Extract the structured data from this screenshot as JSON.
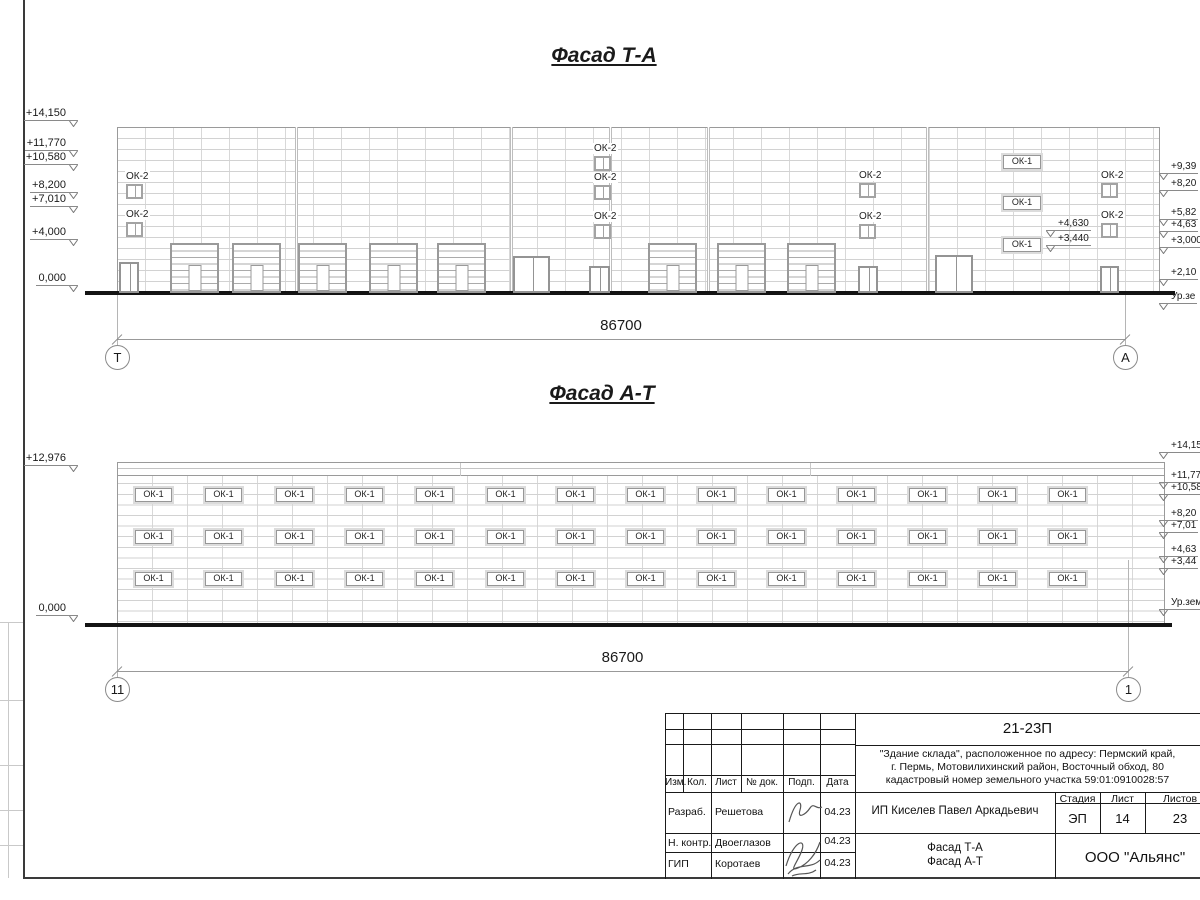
{
  "colors": {
    "line": "#1a1a1a",
    "grid": "#d2d2d2",
    "frame": "#979797",
    "ground": "#141414"
  },
  "facade1": {
    "title": "Фасад Т-А",
    "dimension": "86700",
    "axis_left": "Т",
    "axis_right": "А",
    "small_window_label": "ОК-2",
    "wide_window_label": "ОК-1",
    "marks_left": [
      {
        "t": "+14,150",
        "y": 107
      },
      {
        "t": "+11,770",
        "y": 137
      },
      {
        "t": "+10,580",
        "y": 151
      },
      {
        "t": "+8,200",
        "y": 179
      },
      {
        "t": "+7,010",
        "y": 193
      },
      {
        "t": "+4,000",
        "y": 226
      },
      {
        "t": "0,000",
        "y": 272
      }
    ],
    "marks_right": [
      {
        "t": "+9,39",
        "y": 161
      },
      {
        "t": "+8,20",
        "y": 178
      },
      {
        "t": "+5,82",
        "y": 207
      },
      {
        "t": "+4,63",
        "y": 219
      },
      {
        "t": "+3,000",
        "y": 235
      },
      {
        "t": "+2,10",
        "y": 267
      },
      {
        "t": "Ур.зе",
        "y": 291
      }
    ],
    "inner_marks": [
      {
        "t": "+4,630",
        "x": 1046,
        "y": 218
      },
      {
        "t": "+3,440",
        "x": 1046,
        "y": 233
      }
    ],
    "small_windows": [
      {
        "x": 126,
        "y": 184
      },
      {
        "x": 126,
        "y": 222
      },
      {
        "x": 594,
        "y": 156
      },
      {
        "x": 594,
        "y": 185
      },
      {
        "x": 594,
        "y": 224
      },
      {
        "x": 859,
        "y": 183
      },
      {
        "x": 859,
        "y": 224
      },
      {
        "x": 1101,
        "y": 183
      },
      {
        "x": 1101,
        "y": 223
      }
    ],
    "wide_windows": [
      {
        "x": 1003,
        "y": 155
      },
      {
        "x": 1003,
        "y": 196
      },
      {
        "x": 1003,
        "y": 238
      }
    ],
    "roller_doors_x": [
      170,
      232,
      298,
      369,
      437,
      648,
      717,
      787
    ],
    "single_doors": [
      {
        "x": 119,
        "y": 262,
        "w": 20,
        "h": 31
      },
      {
        "x": 589,
        "y": 266,
        "w": 21,
        "h": 27
      },
      {
        "x": 858,
        "y": 266,
        "w": 20,
        "h": 27
      },
      {
        "x": 1100,
        "y": 266,
        "w": 19,
        "h": 27
      }
    ],
    "double_doors": [
      {
        "x": 513,
        "y": 256,
        "w": 37,
        "h": 37
      },
      {
        "x": 935,
        "y": 255,
        "w": 38,
        "h": 38
      }
    ]
  },
  "facade2": {
    "title": "Фасад А-Т",
    "dimension": "86700",
    "axis_left": "11",
    "axis_right": "1",
    "window_label": "ОК-1",
    "window_cols_x": [
      135,
      205,
      276,
      346,
      416,
      487,
      557,
      627,
      698,
      768,
      838,
      909,
      979,
      1049
    ],
    "window_rows_y": [
      488,
      530,
      572
    ],
    "marks_left": [
      {
        "t": "+12,976",
        "y": 452
      },
      {
        "t": "0,000",
        "y": 602
      }
    ],
    "marks_right": [
      {
        "t": "+14,15",
        "y": 440
      },
      {
        "t": "+11,77",
        "y": 470
      },
      {
        "t": "+10,58",
        "y": 482
      },
      {
        "t": "+8,20",
        "y": 508
      },
      {
        "t": "+7,01",
        "y": 520
      },
      {
        "t": "+4,63",
        "y": 544
      },
      {
        "t": "+3,44",
        "y": 556
      },
      {
        "t": "Ур.зем",
        "y": 597
      }
    ]
  },
  "titleblock": {
    "code": "21-23П",
    "description": [
      "\"Здание склада\", расположенное по адресу: Пермский край,",
      "г. Пермь, Мотовилихинский район, Восточный обход, 80",
      "кадастровый номер земельного участка 59:01:0910028:57"
    ],
    "columns": [
      "Изм.",
      "Кол.",
      "Лист",
      "№ док.",
      "Подп.",
      "Дата"
    ],
    "staff": [
      {
        "role": "Разраб.",
        "name": "Решетова",
        "date": "04.23"
      },
      {
        "role": "Н. контр.",
        "name": "Двоеглазов",
        "date": "04.23"
      },
      {
        "role": "ГИП",
        "name": "Коротаев",
        "date": "04.23"
      }
    ],
    "client": "ИП Киселев Павел Аркадьевич",
    "stage_headers": [
      "Стадия",
      "Лист",
      "Листов"
    ],
    "stage_values": [
      "ЭП",
      "14",
      "23"
    ],
    "sheet_name": [
      "Фасад Т-А",
      "Фасад А-Т"
    ],
    "organization": "ООО \"Альянс\""
  }
}
